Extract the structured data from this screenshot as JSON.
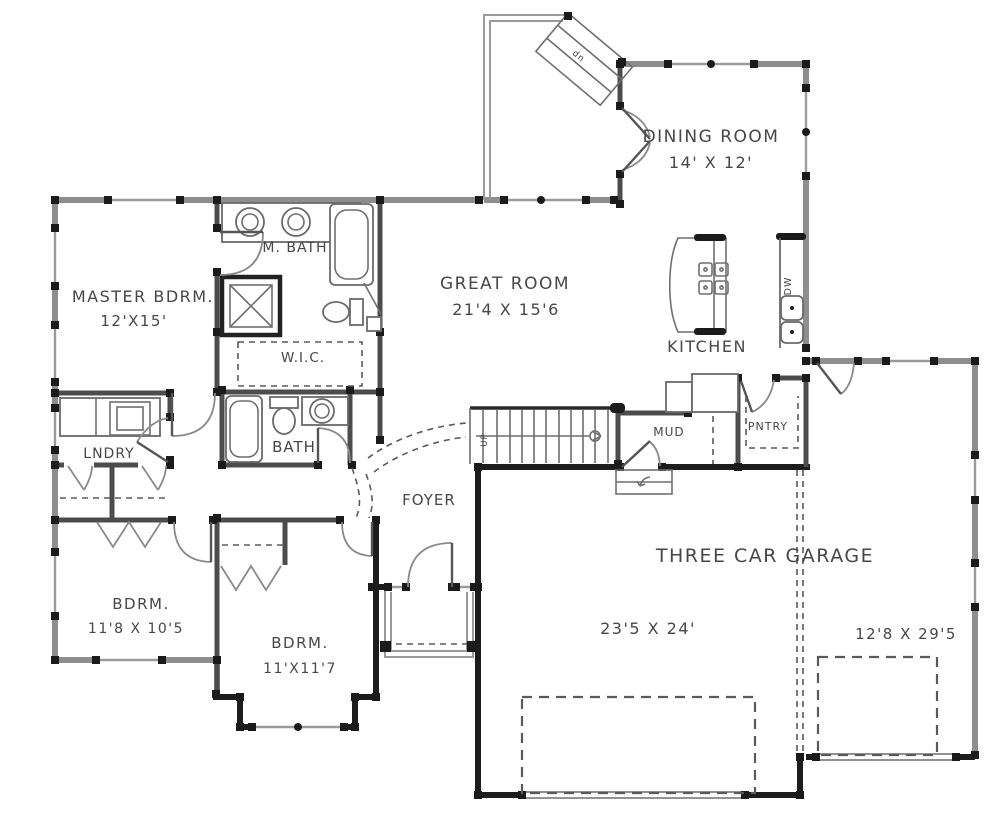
{
  "plan": {
    "type": "floor-plan",
    "colors": {
      "wall_gray": "#8e8e8e",
      "wall_black": "#1d1d1d",
      "label_ink": "#474747",
      "background": "#ffffff"
    },
    "rooms": {
      "dining": {
        "name": "DINING ROOM",
        "dims": "14' X 12'"
      },
      "great": {
        "name": "GREAT ROOM",
        "dims": "21'4 X 15'6"
      },
      "kitchen": {
        "name": "KITCHEN"
      },
      "master": {
        "name": "MASTER BDRM.",
        "dims": "12'X15'"
      },
      "mbath": {
        "name": "M. BATH"
      },
      "wic": {
        "name": "W.I.C."
      },
      "laundry": {
        "name": "LNDRY"
      },
      "bath": {
        "name": "BATH"
      },
      "foyer": {
        "name": "FOYER"
      },
      "mud": {
        "name": "MUD"
      },
      "pantry": {
        "name": "PNTRY"
      },
      "bdrm1": {
        "name": "BDRM.",
        "dims": "11'8 X 10'5"
      },
      "bdrm2": {
        "name": "BDRM.",
        "dims": "11'X11'7"
      },
      "garage": {
        "name": "THREE CAR GARAGE",
        "dims_main": "23'5 X 24'",
        "dims_bay": "12'8 X 29'5"
      }
    },
    "annotations": {
      "dishwasher": "DW",
      "stairs_up": "UP",
      "deck_stairs_down": "dn"
    }
  }
}
